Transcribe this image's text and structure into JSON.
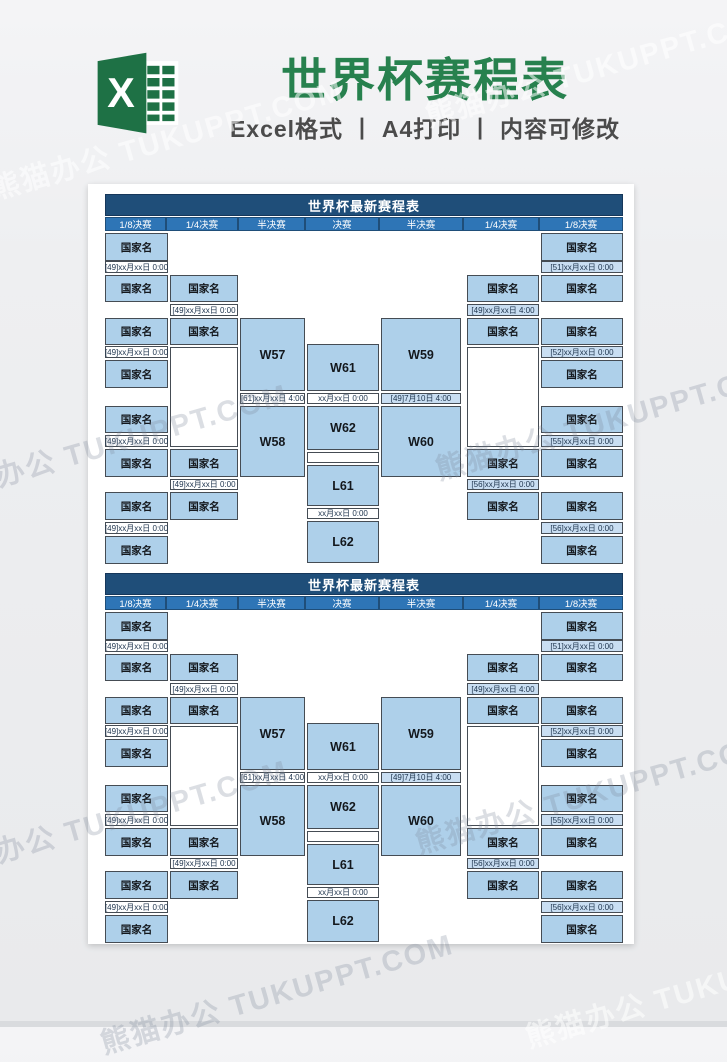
{
  "banner": {
    "title": "世界杯赛程表",
    "subtitle": "Excel格式 丨 A4打印 丨 内容可修改",
    "logo_letter": "X",
    "logo_color": "#1e7145",
    "logo_dark_color": "#18603a",
    "title_color": "#27814e",
    "subtitle_color": "#4b4b4b"
  },
  "watermark": {
    "text": "熊猫办公 TUKUPPT.COM",
    "instances": [
      {
        "x": -15,
        "y": 168,
        "cls": "wm-banner"
      },
      {
        "x": 420,
        "y": 95,
        "cls": "wm-banner"
      },
      {
        "x": -70,
        "y": 472,
        "cls": "wm-page"
      },
      {
        "x": 430,
        "y": 448,
        "cls": "wm-page"
      },
      {
        "x": -70,
        "y": 848,
        "cls": "wm-page"
      },
      {
        "x": 410,
        "y": 822,
        "cls": "wm-page"
      },
      {
        "x": 95,
        "y": 1022,
        "cls": "wm-page"
      },
      {
        "x": 520,
        "y": 1016,
        "cls": "wm-banner"
      }
    ]
  },
  "colors": {
    "title_bar": "#1f4e79",
    "header_row": "#2e75b6",
    "cell_blue": "#aed0ea",
    "date_blue": "#c9def2",
    "border": "#454c54",
    "page_bg": "#ffffff",
    "canvas_bg": "#ebecee"
  },
  "bracket": {
    "title": "世界杯最新赛程表",
    "header_cells": [
      {
        "label": "1/8决赛",
        "x": 0,
        "w": 61
      },
      {
        "label": "1/4决赛",
        "x": 61,
        "w": 72
      },
      {
        "label": "半决赛",
        "x": 133,
        "w": 67
      },
      {
        "label": "决赛",
        "x": 200,
        "w": 74
      },
      {
        "label": "半决赛",
        "x": 274,
        "w": 84
      },
      {
        "label": "1/4决赛",
        "x": 358,
        "w": 76
      },
      {
        "label": "1/8决赛",
        "x": 434,
        "w": 84
      }
    ],
    "boxes": [
      {
        "x": 0,
        "y": 39,
        "w": 63,
        "h": 28,
        "type": "country",
        "text": "国家名"
      },
      {
        "x": 0,
        "y": 67,
        "w": 63,
        "h": 12,
        "type": "date",
        "text": "[49]xx月xx日 0:00"
      },
      {
        "x": 0,
        "y": 81,
        "w": 63,
        "h": 27,
        "type": "country",
        "text": "国家名"
      },
      {
        "x": 0,
        "y": 124,
        "w": 63,
        "h": 27,
        "type": "country",
        "text": "国家名"
      },
      {
        "x": 0,
        "y": 152,
        "w": 63,
        "h": 12,
        "type": "date",
        "text": "[49]xx月xx日 0:00"
      },
      {
        "x": 0,
        "y": 166,
        "w": 63,
        "h": 28,
        "type": "country",
        "text": "国家名"
      },
      {
        "x": 0,
        "y": 212,
        "w": 63,
        "h": 27,
        "type": "country",
        "text": "国家名"
      },
      {
        "x": 0,
        "y": 241,
        "w": 63,
        "h": 12,
        "type": "date",
        "text": "[49]xx月xx日 0:00"
      },
      {
        "x": 0,
        "y": 255,
        "w": 63,
        "h": 28,
        "type": "country",
        "text": "国家名"
      },
      {
        "x": 0,
        "y": 298,
        "w": 63,
        "h": 28,
        "type": "country",
        "text": "国家名"
      },
      {
        "x": 0,
        "y": 328,
        "w": 63,
        "h": 12,
        "type": "date",
        "text": "[49]xx月xx日 0:00"
      },
      {
        "x": 0,
        "y": 342,
        "w": 63,
        "h": 28,
        "type": "country",
        "text": "国家名"
      },
      {
        "x": 65,
        "y": 81,
        "w": 68,
        "h": 27,
        "type": "country",
        "text": "国家名"
      },
      {
        "x": 65,
        "y": 110,
        "w": 68,
        "h": 12,
        "type": "date",
        "text": "[49]xx月xx日 0:00"
      },
      {
        "x": 65,
        "y": 124,
        "w": 68,
        "h": 27,
        "type": "country",
        "text": "国家名"
      },
      {
        "x": 65,
        "y": 153,
        "w": 68,
        "h": 100,
        "type": "slot",
        "text": ""
      },
      {
        "x": 65,
        "y": 255,
        "w": 68,
        "h": 28,
        "type": "country",
        "text": "国家名"
      },
      {
        "x": 65,
        "y": 285,
        "w": 68,
        "h": 11,
        "type": "date",
        "text": "[49]xx月xx日 0:00"
      },
      {
        "x": 65,
        "y": 298,
        "w": 68,
        "h": 28,
        "type": "country",
        "text": "国家名"
      },
      {
        "x": 135,
        "y": 124,
        "w": 65,
        "h": 73,
        "type": "match",
        "text": "W57"
      },
      {
        "x": 135,
        "y": 199,
        "w": 65,
        "h": 11,
        "type": "date",
        "text": "[61]xx月xx日 4:00"
      },
      {
        "x": 135,
        "y": 212,
        "w": 65,
        "h": 71,
        "type": "match",
        "text": "W58"
      },
      {
        "x": 202,
        "y": 150,
        "w": 72,
        "h": 47,
        "type": "match",
        "text": "W61"
      },
      {
        "x": 202,
        "y": 199,
        "w": 72,
        "h": 11,
        "type": "date",
        "text": "xx月xx日 0:00"
      },
      {
        "x": 202,
        "y": 212,
        "w": 72,
        "h": 44,
        "type": "match",
        "text": "W62"
      },
      {
        "x": 202,
        "y": 258,
        "w": 72,
        "h": 11,
        "type": "slot",
        "text": ""
      },
      {
        "x": 202,
        "y": 271,
        "w": 72,
        "h": 41,
        "type": "match",
        "text": "L61"
      },
      {
        "x": 202,
        "y": 314,
        "w": 72,
        "h": 11,
        "type": "date",
        "text": "xx月xx日 0:00"
      },
      {
        "x": 202,
        "y": 327,
        "w": 72,
        "h": 42,
        "type": "match",
        "text": "L62"
      },
      {
        "x": 276,
        "y": 124,
        "w": 80,
        "h": 73,
        "type": "match",
        "text": "W59"
      },
      {
        "x": 276,
        "y": 199,
        "w": 80,
        "h": 11,
        "type": "date_blue",
        "text": "[49]7月10日 4:00"
      },
      {
        "x": 276,
        "y": 212,
        "w": 80,
        "h": 71,
        "type": "match",
        "text": "W60"
      },
      {
        "x": 362,
        "y": 81,
        "w": 72,
        "h": 27,
        "type": "country",
        "text": "国家名"
      },
      {
        "x": 362,
        "y": 110,
        "w": 72,
        "h": 12,
        "type": "date_blue",
        "text": "[49]xx月xx日 4:00"
      },
      {
        "x": 362,
        "y": 124,
        "w": 72,
        "h": 27,
        "type": "country",
        "text": "国家名"
      },
      {
        "x": 362,
        "y": 153,
        "w": 72,
        "h": 100,
        "type": "slot",
        "text": ""
      },
      {
        "x": 362,
        "y": 255,
        "w": 72,
        "h": 28,
        "type": "country",
        "text": "国家名"
      },
      {
        "x": 362,
        "y": 285,
        "w": 72,
        "h": 11,
        "type": "date_blue",
        "text": "[56]xx月xx日 0:00"
      },
      {
        "x": 362,
        "y": 298,
        "w": 72,
        "h": 28,
        "type": "country",
        "text": "国家名"
      },
      {
        "x": 436,
        "y": 39,
        "w": 82,
        "h": 28,
        "type": "country",
        "text": "国家名"
      },
      {
        "x": 436,
        "y": 67,
        "w": 82,
        "h": 12,
        "type": "date_blue",
        "text": "[51]xx月xx日 0:00"
      },
      {
        "x": 436,
        "y": 81,
        "w": 82,
        "h": 27,
        "type": "country",
        "text": "国家名"
      },
      {
        "x": 436,
        "y": 124,
        "w": 82,
        "h": 27,
        "type": "country",
        "text": "国家名"
      },
      {
        "x": 436,
        "y": 152,
        "w": 82,
        "h": 12,
        "type": "date_blue",
        "text": "[52]xx月xx日 0:00"
      },
      {
        "x": 436,
        "y": 166,
        "w": 82,
        "h": 28,
        "type": "country",
        "text": "国家名"
      },
      {
        "x": 436,
        "y": 212,
        "w": 82,
        "h": 27,
        "type": "country",
        "text": "国家名"
      },
      {
        "x": 436,
        "y": 241,
        "w": 82,
        "h": 12,
        "type": "date_blue",
        "text": "[55]xx月xx日 0:00"
      },
      {
        "x": 436,
        "y": 255,
        "w": 82,
        "h": 28,
        "type": "country",
        "text": "国家名"
      },
      {
        "x": 436,
        "y": 298,
        "w": 82,
        "h": 28,
        "type": "country",
        "text": "国家名"
      },
      {
        "x": 436,
        "y": 328,
        "w": 82,
        "h": 12,
        "type": "date_blue",
        "text": "[56]xx月xx日 0:00"
      },
      {
        "x": 436,
        "y": 342,
        "w": 82,
        "h": 28,
        "type": "country",
        "text": "国家名"
      }
    ]
  }
}
